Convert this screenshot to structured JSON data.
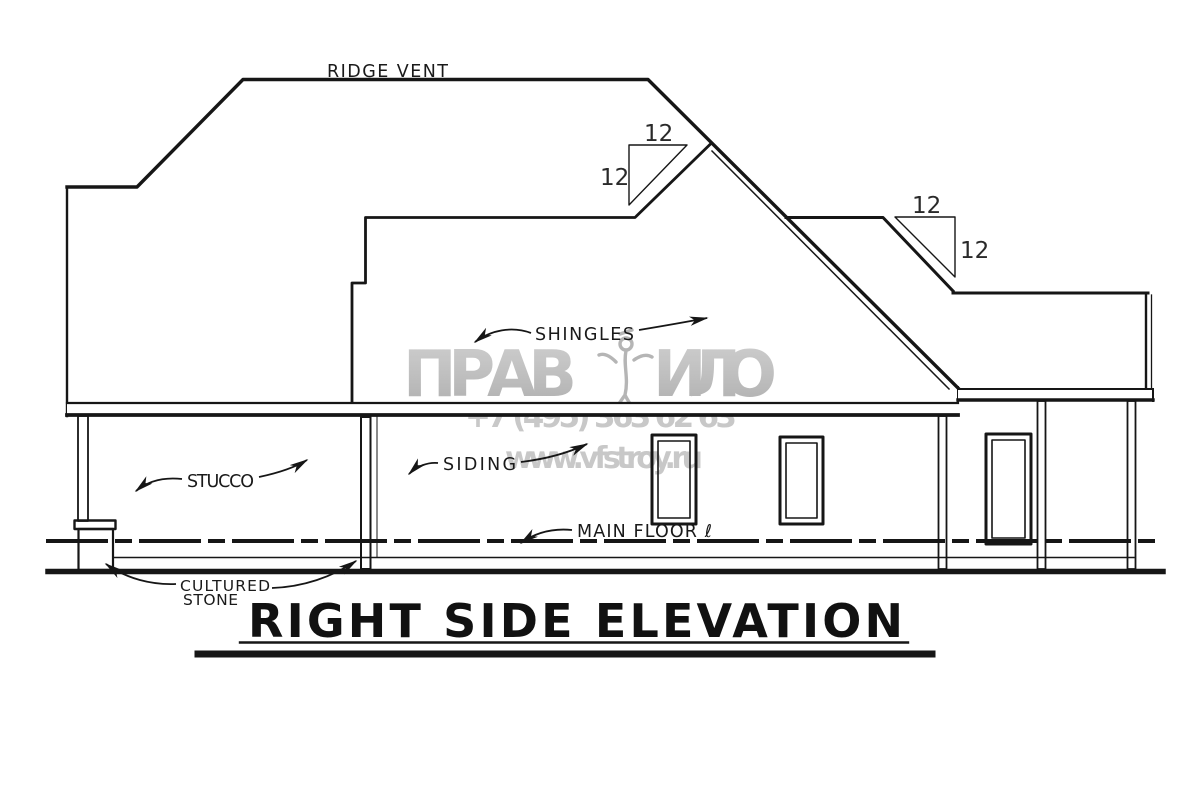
{
  "drawing": {
    "title": "RIGHT SIDE ELEVATION",
    "annotations": {
      "ridge_vent": "RIDGE VENT",
      "shingles": "SHINGLES",
      "stucco": "STUCCO",
      "siding": "SIDING",
      "main_floor": "MAIN FLOOR ℓ",
      "cultured_stone_line1": "CULTURED",
      "cultured_stone_line2": "STONE"
    },
    "slopes": {
      "upper": {
        "run": "12",
        "rise": "12"
      },
      "lower": {
        "run": "12",
        "rise": "12"
      }
    }
  },
  "watermark": {
    "brand_left": "ПРАВ",
    "brand_right": "ИЛО",
    "phone": "+7 (495) 363 62 63",
    "website": "www.vfstroy.ru"
  },
  "colors": {
    "ink": "#161616",
    "paper": "#ffffff",
    "watermark_gray": "#bcbcbc"
  }
}
